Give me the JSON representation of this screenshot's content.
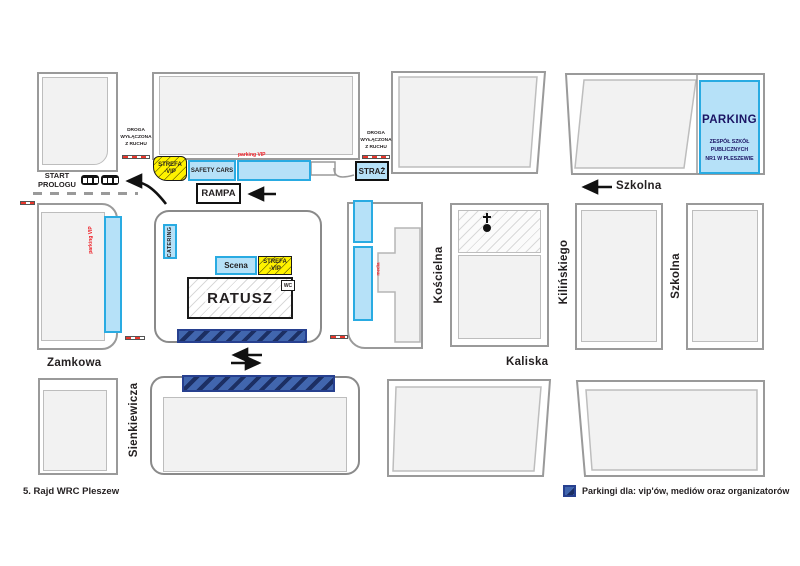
{
  "title": "5. Rajd WRC Pleszew",
  "footer": "5. Rajd WRC Pleszew",
  "colors": {
    "service_blue_fill": "#b6e1f8",
    "service_blue_border": "#29abe2",
    "vip_yellow": "#fff200",
    "parking_navy": "#4166ae",
    "barrier_red": "#e8372c",
    "red_text": "#ed1c24",
    "building_fill": "#f2f2f2",
    "building_border": "#9a9a9a",
    "parking_text_navy": "#1b1464"
  },
  "streets": {
    "szkolna_top": "Szkolna",
    "szkolna_right": "Szkolna",
    "zamkowa": "Zamkowa",
    "kaliska": "Kaliska",
    "sienkiewicza": "Sienkiewicza",
    "koscielna": "Kościelna",
    "kilinskiego": "Kilińskiego"
  },
  "labels": {
    "start_line1": "START",
    "start_line2": "PROLOGU",
    "rampa": "RAMPA",
    "straz": "STRAŻ",
    "safety_cars": "SAFETY CARS",
    "strefa_line1": "STREFA",
    "strefa_line2": "-VIP",
    "catering": "CATERING",
    "scena": "Scena",
    "ratusz": "RATUSZ",
    "wc": "WC",
    "droga_line1": "DROGA",
    "droga_line2": "WYŁĄCZONA",
    "droga_line3": "Z RUCHU",
    "parking_title": "PARKING",
    "parking_sub1": "ZESPÓŁ SZKÓŁ",
    "parking_sub2": "PUBLICZNYCH",
    "parking_sub3": "NR1 W PLESZEWIE",
    "red_parking_top": "parking VIP",
    "red_parking_left": "parking VIP",
    "red_media": "media"
  },
  "legend": {
    "text": "Parkingi dla: vip'ów, mediów oraz organizatorów"
  }
}
